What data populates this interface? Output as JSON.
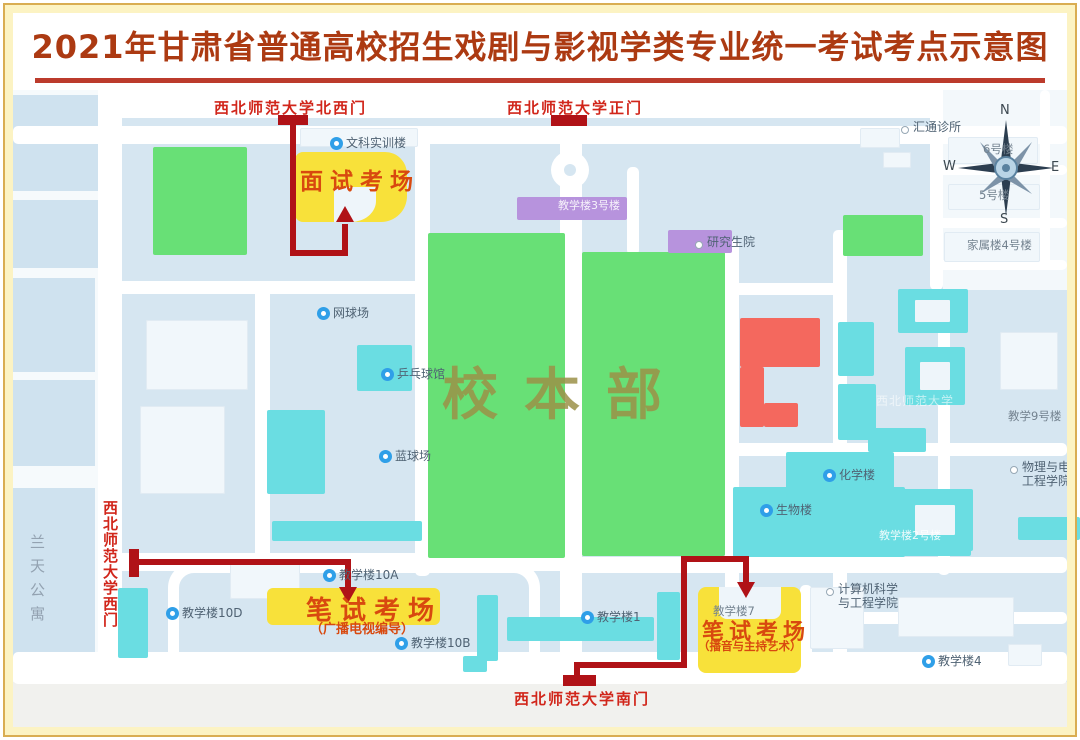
{
  "title": {
    "text": "2021年甘肃省普通高校招生戏剧与影视学类专业统一考试考点示意图"
  },
  "colors": {
    "map_bg": "#d6e6f1",
    "road": "#ffffff",
    "building_teal": "#6adde2",
    "building_purple": "#b793dd",
    "building_red": "#f4685e",
    "field_green": "#68e076",
    "exam_yellow": "#f8e13a",
    "route_red": "#b01217",
    "gate_label_red": "#d1261b",
    "exam_text_orange": "#d8490f",
    "title_color": "#ac3a12",
    "frame_gold": "#d9ad52",
    "frame_yellow": "#fcf3c3",
    "pin_blue": "#2f9fe8",
    "campus_text": "#9b9048"
  },
  "gates": {
    "northwest": {
      "label": "西北师范大学北西门"
    },
    "main": {
      "label": "西北师范大学正门"
    },
    "west": {
      "label": "西北师范大学西门"
    },
    "south": {
      "label": "西北师范大学南门"
    }
  },
  "exam_sites": {
    "interview": {
      "label": "面试考场"
    },
    "written_broadcast": {
      "label": "笔试考场",
      "subtitle": "（广播电视编导）"
    },
    "written_hosting": {
      "label": "笔试考场",
      "subtitle": "（播音与主持艺术）"
    }
  },
  "campus_label": {
    "text": "校本部"
  },
  "apartment": {
    "text": "兰天公寓"
  },
  "compass": {
    "n": "N",
    "e": "E",
    "s": "S",
    "w": "W"
  },
  "map": {
    "pois": [
      {
        "label": "文科实训楼",
        "type": "pin",
        "x": 346,
        "y": 137
      },
      {
        "label": "网球场",
        "type": "pin",
        "x": 333,
        "y": 307
      },
      {
        "label": "乒乓球馆",
        "type": "pin",
        "x": 397,
        "y": 368
      },
      {
        "label": "蓝球场",
        "type": "pin",
        "x": 395,
        "y": 450
      },
      {
        "label": "教学楼10A",
        "type": "pin",
        "x": 339,
        "y": 569
      },
      {
        "label": "教学楼10D",
        "type": "pin",
        "x": 182,
        "y": 607
      },
      {
        "label": "教学楼10B",
        "type": "pin",
        "x": 411,
        "y": 637
      },
      {
        "label": "教学楼1",
        "type": "pin",
        "x": 597,
        "y": 611
      },
      {
        "label": "教学楼4",
        "type": "pin",
        "x": 938,
        "y": 655
      },
      {
        "label": "化学楼",
        "type": "pin",
        "x": 839,
        "y": 469
      },
      {
        "label": "生物楼",
        "type": "pin",
        "x": 776,
        "y": 504
      },
      {
        "label": "汇通诊所",
        "type": "dot",
        "x": 913,
        "y": 121
      },
      {
        "label": "研究生院",
        "type": "dot",
        "x": 707,
        "y": 236
      },
      {
        "label": "计算机科学\n与工程学院",
        "type": "dot",
        "x": 838,
        "y": 583
      },
      {
        "label": "物理与电\n工程学院",
        "type": "dot",
        "x": 1022,
        "y": 461
      },
      {
        "label": "教学9号楼",
        "type": "plain-gray",
        "x": 1008,
        "y": 410
      },
      {
        "label": "教学楼3号楼",
        "type": "faint-white",
        "x": 558,
        "y": 200
      },
      {
        "label": "西北师范大学",
        "type": "faint-dim",
        "x": 876,
        "y": 395
      },
      {
        "label": "教学楼2号楼",
        "type": "faint-white",
        "x": 879,
        "y": 530
      },
      {
        "label": "教学楼7",
        "type": "plain-gray",
        "x": 713,
        "y": 605
      },
      {
        "label": "6号楼",
        "type": "plain-gray",
        "x": 983,
        "y": 143
      },
      {
        "label": "5号楼",
        "type": "plain-gray",
        "x": 979,
        "y": 189
      },
      {
        "label": "家属楼4号楼",
        "type": "plain-gray",
        "x": 967,
        "y": 239
      }
    ]
  }
}
